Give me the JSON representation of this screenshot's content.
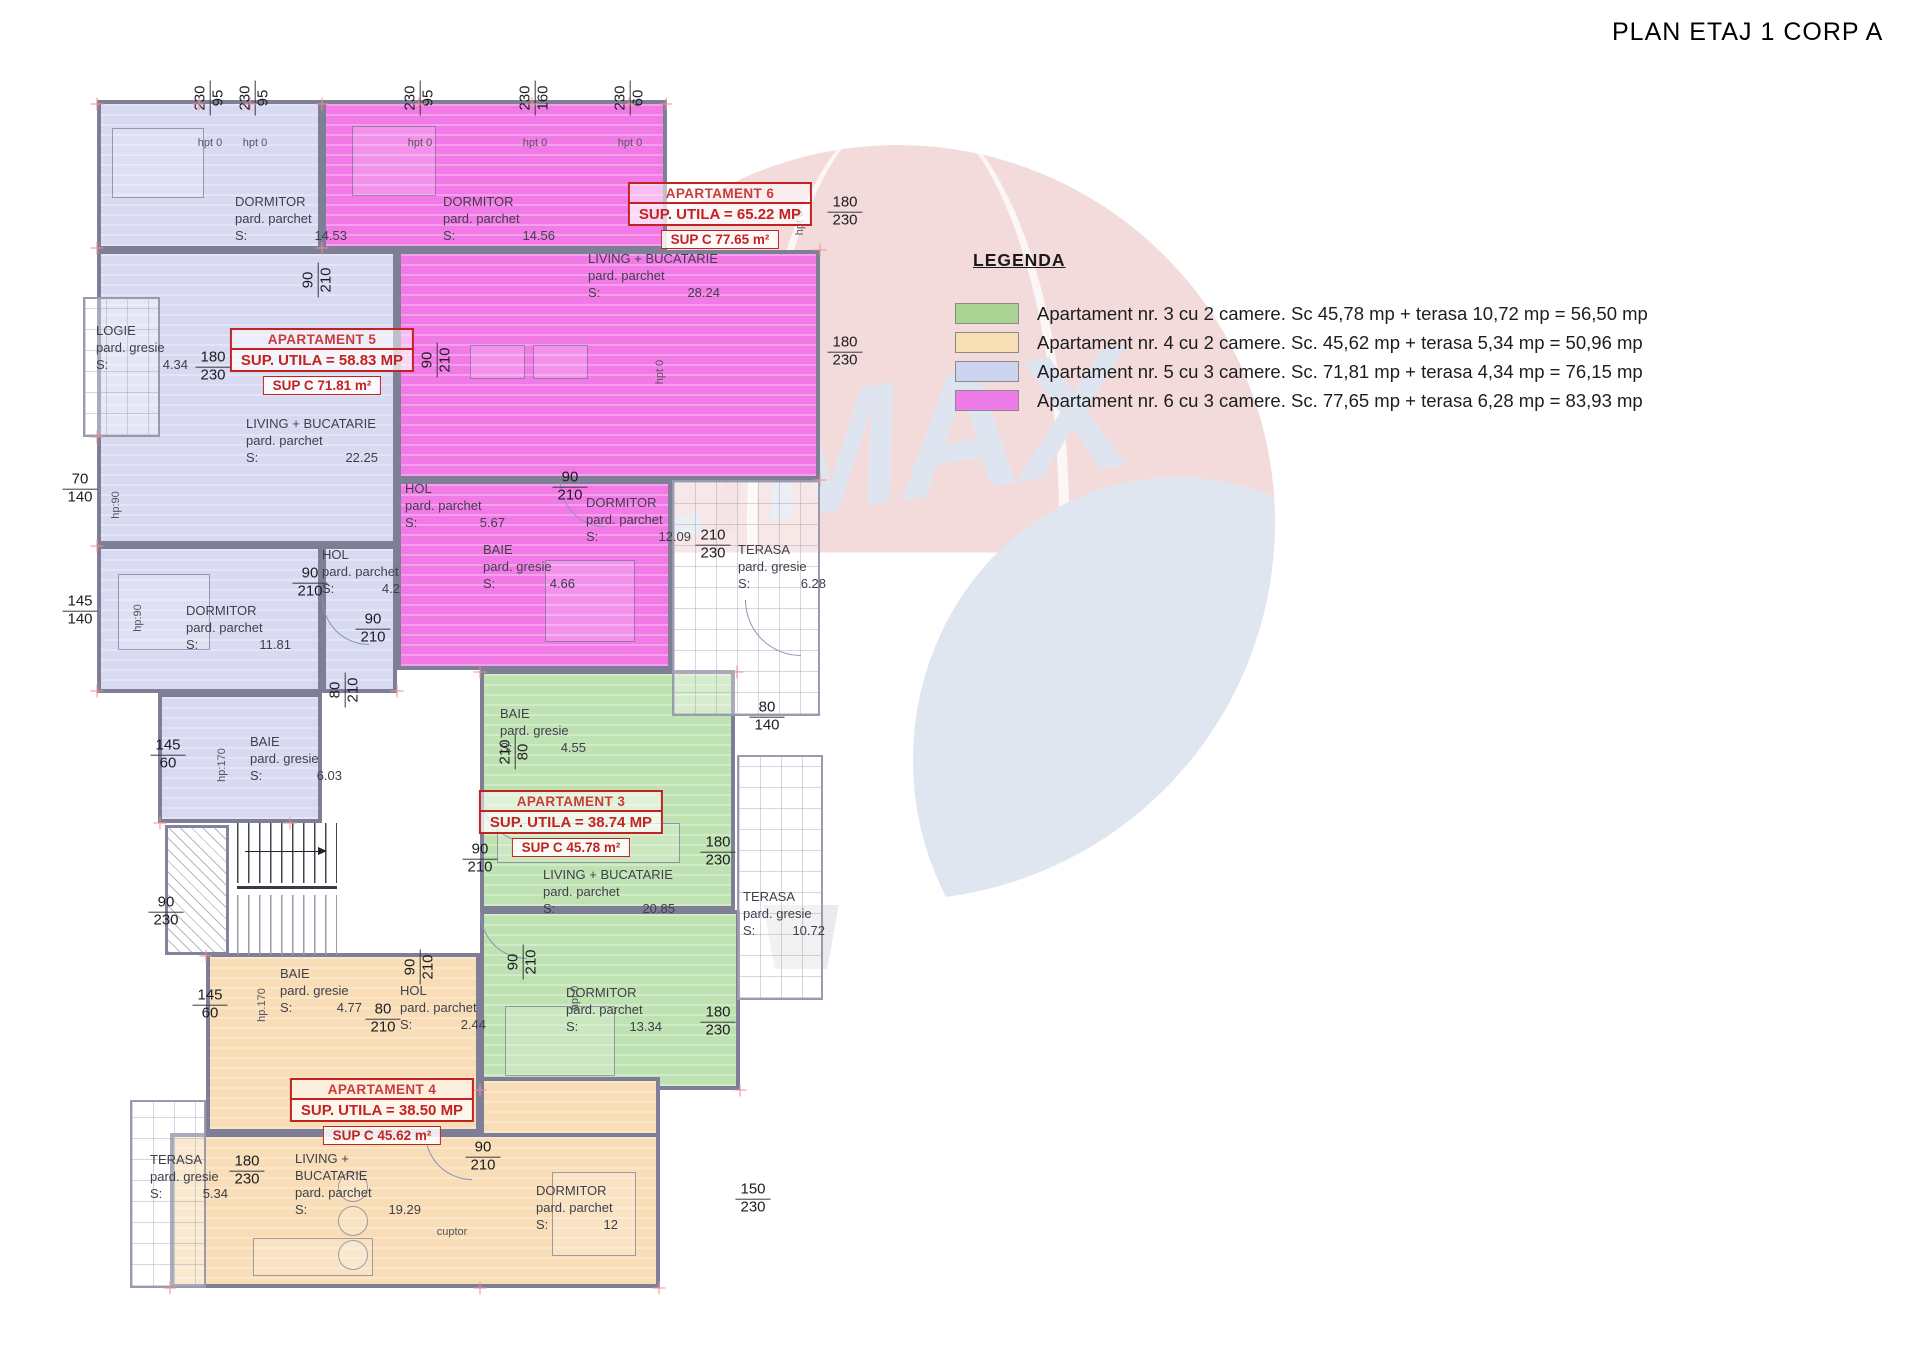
{
  "title": "PLAN ETAJ 1 CORP A",
  "watermark": {
    "re": "RE",
    "slash": "/",
    "max": "MAX"
  },
  "legend": {
    "heading": "LEGENDA",
    "items": [
      {
        "color": "#a9d494",
        "text": "Apartament nr. 3 cu 2 camere. Sc  45,78 mp + terasa 10,72 mp = 56,50 mp"
      },
      {
        "color": "#f7dfb5",
        "text": "Apartament nr. 4 cu 2 camere. Sc. 45,62 mp + terasa 5,34 mp = 50,96 mp"
      },
      {
        "color": "#ccd4f0",
        "text": "Apartament nr. 5 cu 3 camere. Sc. 71,81 mp + terasa 4,34 mp = 76,15 mp"
      },
      {
        "color": "#ee7ce8",
        "text": "Apartament nr. 6 cu 3 camere. Sc. 77,65 mp + terasa 6,28 mp = 83,93 mp"
      }
    ]
  },
  "apartments": [
    {
      "key": "apt3",
      "name": "APARTAMENT 3",
      "sup_utila": "SUP. UTILA = 38.74 MP",
      "sup_c": "SUP C 45.78 m²",
      "fill": "#bfe2b2",
      "label_x": 571,
      "label_y": 790
    },
    {
      "key": "apt4",
      "name": "APARTAMENT 4",
      "sup_utila": "SUP. UTILA = 38.50 MP",
      "sup_c": "SUP C 45.62 m²",
      "fill": "#f8ddb6",
      "label_x": 382,
      "label_y": 1078
    },
    {
      "key": "apt5",
      "name": "APARTAMENT 5",
      "sup_utila": "SUP. UTILA = 58.83 MP",
      "sup_c": "SUP C 71.81 m²",
      "fill": "#d8daf1",
      "label_x": 322,
      "label_y": 328
    },
    {
      "key": "apt6",
      "name": "APARTAMENT 6",
      "sup_utila": "SUP. UTILA = 65.22 MP",
      "sup_c": "SUP C 77.65 m²",
      "fill": "#f17ae6",
      "label_x": 720,
      "label_y": 182
    }
  ],
  "rooms": [
    {
      "name": "DORMITOR",
      "floor": "pard. parchet",
      "s": "S:",
      "area": "14.53",
      "x": 235,
      "y": 193,
      "w": 112
    },
    {
      "name": "LOGIE",
      "floor": "pard. gresie",
      "s": "S:",
      "area": "4.34",
      "x": 96,
      "y": 322,
      "w": 92
    },
    {
      "name": "LIVING + BUCATARIE",
      "floor": "pard. parchet",
      "s": "S:",
      "area": "22.25",
      "x": 246,
      "y": 415,
      "w": 132
    },
    {
      "name": "HOL",
      "floor": "pard. parchet",
      "s": "S:",
      "area": "4.2",
      "x": 322,
      "y": 546,
      "w": 78
    },
    {
      "name": "DORMITOR",
      "floor": "pard. parchet",
      "s": "S:",
      "area": "11.81",
      "x": 186,
      "y": 602,
      "w": 105
    },
    {
      "name": "BAIE",
      "floor": "pard. gresie",
      "s": "S:",
      "area": "6.03",
      "x": 250,
      "y": 733,
      "w": 92
    },
    {
      "name": "DORMITOR",
      "floor": "pard. parchet",
      "s": "S:",
      "area": "14.56",
      "x": 443,
      "y": 193,
      "w": 112
    },
    {
      "name": "LIVING + BUCATARIE",
      "floor": "pard. parchet",
      "s": "S:",
      "area": "28.24",
      "x": 588,
      "y": 250,
      "w": 132
    },
    {
      "name": "HOL",
      "floor": "pard. parchet",
      "s": "S:",
      "area": "5.67",
      "x": 405,
      "y": 480,
      "w": 100
    },
    {
      "name": "BAIE",
      "floor": "pard. gresie",
      "s": "S:",
      "area": "4.66",
      "x": 483,
      "y": 541,
      "w": 92
    },
    {
      "name": "DORMITOR",
      "floor": "pard. parchet",
      "s": "S:",
      "area": "12.09",
      "x": 586,
      "y": 494,
      "w": 105
    },
    {
      "name": "TERASA",
      "floor": "pard. gresie",
      "s": "S:",
      "area": "6.28",
      "x": 738,
      "y": 541,
      "w": 88
    },
    {
      "name": "BAIE",
      "floor": "pard. gresie",
      "s": "S:",
      "area": "4.55",
      "x": 500,
      "y": 705,
      "w": 86
    },
    {
      "name": "LIVING + BUCATARIE",
      "floor": "pard. parchet",
      "s": "S:",
      "area": "20.85",
      "x": 543,
      "y": 866,
      "w": 132
    },
    {
      "name": "DORMITOR",
      "floor": "pard. parchet",
      "s": "S:",
      "area": "13.34",
      "x": 566,
      "y": 984,
      "w": 96
    },
    {
      "name": "TERASA",
      "floor": "pard. gresie",
      "s": "S:",
      "area": "10.72",
      "x": 743,
      "y": 888,
      "w": 82
    },
    {
      "name": "BAIE",
      "floor": "pard. gresie",
      "s": "S:",
      "area": "4.77",
      "x": 280,
      "y": 965,
      "w": 82
    },
    {
      "name": "HOL",
      "floor": "pard. parchet",
      "s": "S:",
      "area": "2.44",
      "x": 400,
      "y": 982,
      "w": 86
    },
    {
      "name": "LIVING + BUCATARIE",
      "floor": "pard. parchet",
      "s": "S:",
      "area": "19.29",
      "x": 295,
      "y": 1150,
      "w": 126
    },
    {
      "name": "DORMITOR",
      "floor": "pard. parchet",
      "s": "S:",
      "area": "12",
      "x": 536,
      "y": 1182,
      "w": 82
    },
    {
      "name": "TERASA",
      "floor": "pard. gresie",
      "s": "S:",
      "area": "5.34",
      "x": 150,
      "y": 1151,
      "w": 78
    }
  ],
  "dims": [
    {
      "t": "180",
      "b": "230",
      "x": 845,
      "y": 212
    },
    {
      "t": "180",
      "b": "230",
      "x": 845,
      "y": 352
    },
    {
      "t": "80",
      "b": "140",
      "x": 767,
      "y": 717
    },
    {
      "t": "180",
      "b": "230",
      "x": 718,
      "y": 852
    },
    {
      "t": "180",
      "b": "230",
      "x": 718,
      "y": 1022
    },
    {
      "t": "150",
      "b": "230",
      "x": 753,
      "y": 1199
    },
    {
      "t": "70",
      "b": "140",
      "x": 80,
      "y": 489
    },
    {
      "t": "145",
      "b": "140",
      "x": 80,
      "y": 611
    },
    {
      "t": "145",
      "b": "60",
      "x": 168,
      "y": 755
    },
    {
      "t": "90",
      "b": "230",
      "x": 166,
      "y": 912
    },
    {
      "t": "145",
      "b": "60",
      "x": 210,
      "y": 1005
    },
    {
      "t": "180",
      "b": "230",
      "x": 247,
      "y": 1171
    },
    {
      "t": "180",
      "b": "230",
      "x": 213,
      "y": 367
    },
    {
      "t": "90",
      "b": "210",
      "x": 570,
      "y": 487
    },
    {
      "t": "90",
      "b": "210",
      "x": 310,
      "y": 583
    },
    {
      "t": "90",
      "b": "210",
      "x": 373,
      "y": 629
    },
    {
      "t": "210",
      "b": "230",
      "x": 713,
      "y": 545
    },
    {
      "t": "90",
      "b": "210",
      "x": 480,
      "y": 859
    },
    {
      "t": "90",
      "b": "210",
      "x": 483,
      "y": 1157
    },
    {
      "t": "80",
      "b": "210",
      "x": 383,
      "y": 1019
    },
    {
      "t": "90",
      "b": "210",
      "x": 318,
      "y": 280,
      "rot": 1
    },
    {
      "t": "90",
      "b": "210",
      "x": 437,
      "y": 360,
      "rot": 1
    },
    {
      "t": "80",
      "b": "210",
      "x": 345,
      "y": 690,
      "rot": 1
    },
    {
      "t": "210",
      "b": "80",
      "x": 515,
      "y": 752,
      "rot": 1
    },
    {
      "t": "90",
      "b": "210",
      "x": 523,
      "y": 962,
      "rot": 1
    },
    {
      "t": "90",
      "b": "210",
      "x": 420,
      "y": 967,
      "rot": 1
    },
    {
      "t": "230",
      "b": "95",
      "x": 210,
      "y": 98,
      "rot": 1
    },
    {
      "t": "230",
      "b": "95",
      "x": 255,
      "y": 98,
      "rot": 1
    },
    {
      "t": "230",
      "b": "95",
      "x": 420,
      "y": 98,
      "rot": 1
    },
    {
      "t": "230",
      "b": "160",
      "x": 535,
      "y": 98,
      "rot": 1
    },
    {
      "t": "230",
      "b": "60",
      "x": 630,
      "y": 98,
      "rot": 1
    }
  ],
  "wall_labels": [
    {
      "text": "hp:90",
      "x": 116,
      "y": 505,
      "rot": 1
    },
    {
      "text": "hp:90",
      "x": 138,
      "y": 618,
      "rot": 1
    },
    {
      "text": "hp:170",
      "x": 222,
      "y": 765,
      "rot": 1
    },
    {
      "text": "hp.170",
      "x": 262,
      "y": 1005,
      "rot": 1
    },
    {
      "text": "hpt 0",
      "x": 800,
      "y": 223,
      "rot": 1
    },
    {
      "text": "hpt 0",
      "x": 660,
      "y": 372,
      "rot": 1
    },
    {
      "text": "hpt 0",
      "x": 575,
      "y": 998,
      "rot": 1
    },
    {
      "text": "hpt 0",
      "x": 210,
      "y": 143
    },
    {
      "text": "hpt 0",
      "x": 255,
      "y": 143
    },
    {
      "text": "hpt 0",
      "x": 420,
      "y": 143
    },
    {
      "text": "hpt 0",
      "x": 535,
      "y": 143
    },
    {
      "text": "hpt 0",
      "x": 630,
      "y": 143
    },
    {
      "text": "cuptor",
      "x": 452,
      "y": 1232
    }
  ]
}
